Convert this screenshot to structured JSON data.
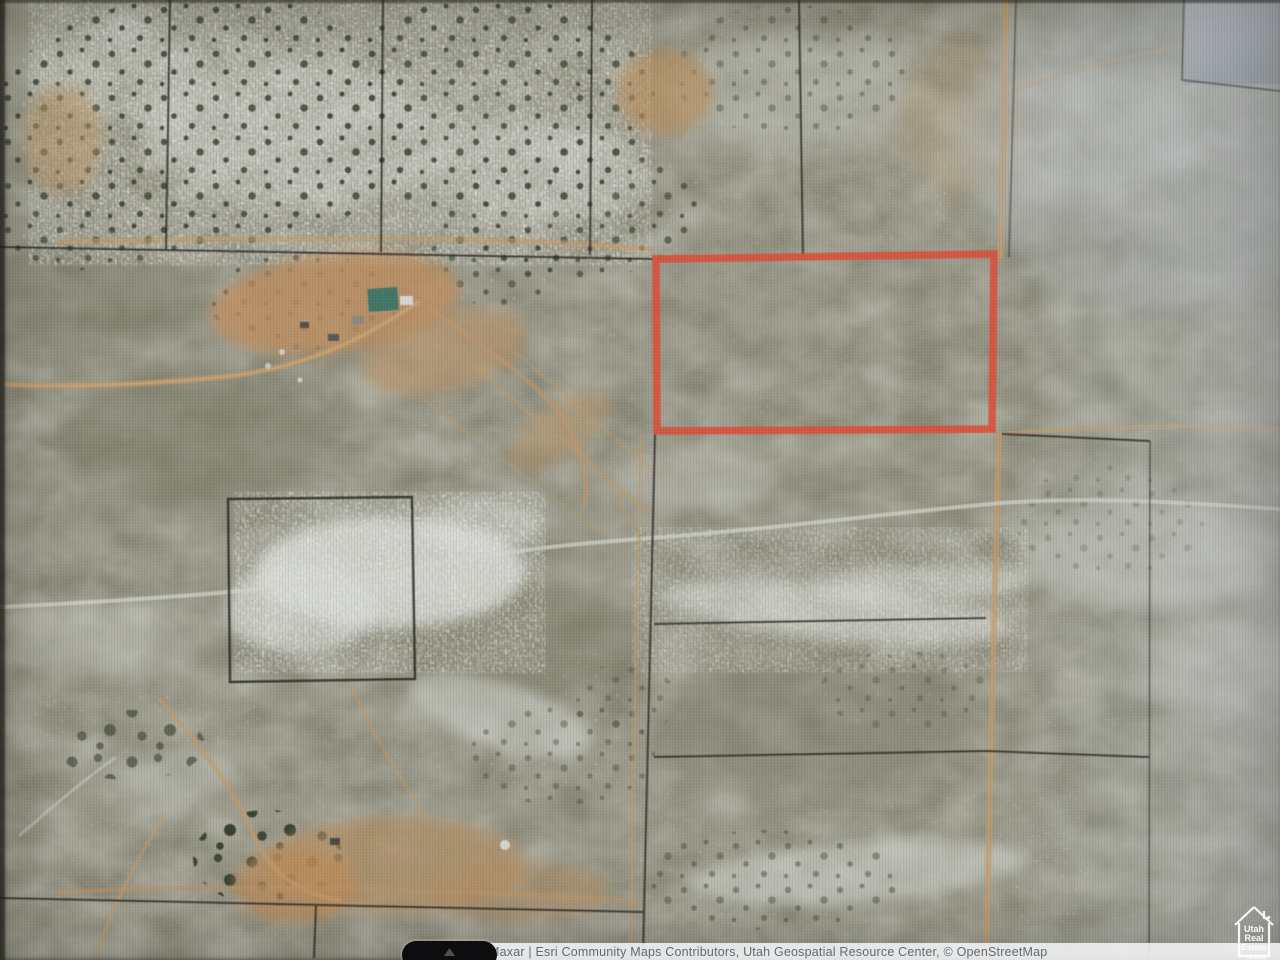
{
  "map": {
    "kind": "satellite-parcel-map",
    "attribution": {
      "text": "Maxar | Esri Community Maps Contributors, Utah Geospatial Resource Center, © OpenStreetMap"
    },
    "watermark": {
      "lines": [
        "Utah",
        "Real",
        "Estate",
        ".com"
      ]
    },
    "icons": {
      "esri_button": "esri-attribution-toggle-icon",
      "watermark_house": "house-icon"
    },
    "colors": {
      "parcel_highlight": "#e44f38",
      "parcel_boundary": "#23231f",
      "dirt_road": "#c49b68",
      "light_road": "#d6d8cd",
      "attribution_bar_bg": "#f3f4f6",
      "attribution_text": "#626a76",
      "watermark": "#ffffff"
    }
  }
}
